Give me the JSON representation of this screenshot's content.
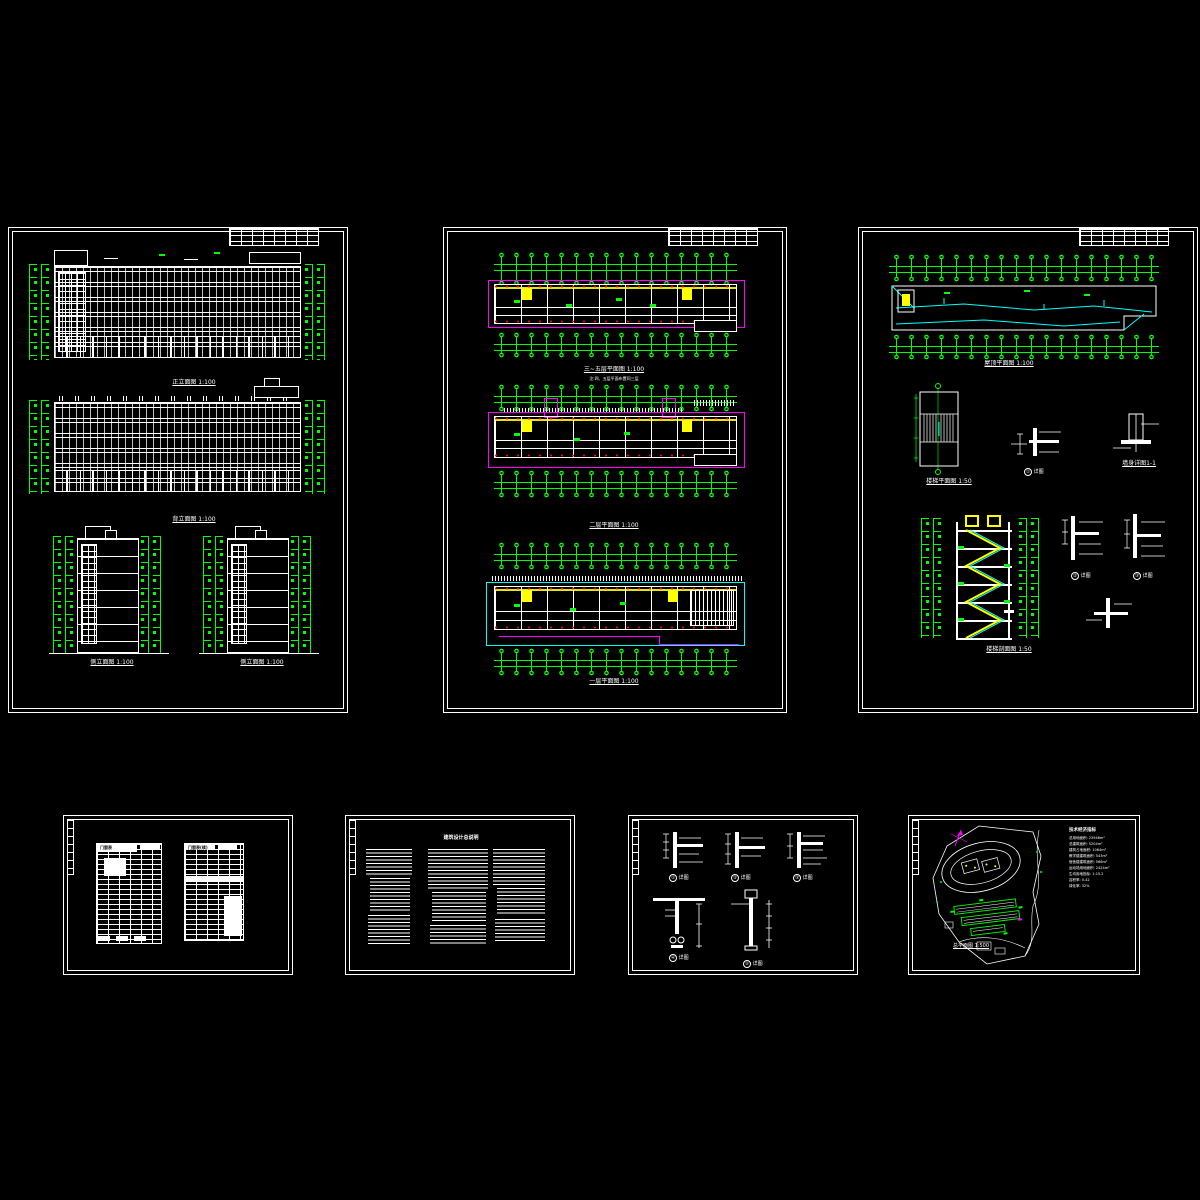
{
  "canvas": {
    "background": "#000000"
  },
  "palette": {
    "line": "#ffffff",
    "dimension": "#00ff00",
    "wall_axis": "#ff00ff",
    "auxiliary": "#00ffff",
    "highlight": "#ffff00",
    "node": "#ff0000"
  },
  "sheets": {
    "elevations": {
      "label": "立面图图纸",
      "titles": {
        "front": "正立面图 1:100",
        "rear": "背立面图 1:100",
        "side_left": "侧立面图 1:100",
        "side_right": "侧立面图 1:100"
      }
    },
    "plans": {
      "label": "平面图图纸",
      "titles": {
        "upper": "三~五层平面图 1:100",
        "upper_note": "注:四、五层平面布置同三层",
        "second": "二层平面图 1:100",
        "first": "一层平面图 1:100"
      }
    },
    "roof": {
      "label": "屋顶及楼梯详图图纸",
      "titles": {
        "roof_plan": "屋顶平面图 1:100",
        "stair_plan": "楼梯平面图 1:50",
        "stair_section": "楼梯剖面图 1:50",
        "wall_section": "墙身详图1-1"
      },
      "detail_items": [
        {
          "num": "①",
          "name": "详图"
        },
        {
          "num": "②",
          "name": "详图"
        },
        {
          "num": "③",
          "name": "详图"
        }
      ]
    },
    "schedule": {
      "label": "门窗表图纸",
      "table1_title": "门窗表",
      "table2_title": "门窗表(续)"
    },
    "notes": {
      "label": "设计说明图纸",
      "title": "建筑设计总说明"
    },
    "details": {
      "label": "节点详图图纸",
      "items": [
        {
          "num": "①",
          "name": "详图"
        },
        {
          "num": "②",
          "name": "详图"
        },
        {
          "num": "③",
          "name": "详图"
        },
        {
          "num": "④",
          "name": "详图"
        },
        {
          "num": "⑤",
          "name": "详图"
        }
      ]
    },
    "site": {
      "label": "总平面图图纸",
      "title": "总平面图 1:500",
      "indicators": {
        "title": "技术经济指标",
        "lines": [
          "总用地面积: 23946m²",
          "总建筑面积: 5204m²",
          "建筑占地面积: 1064m²",
          "教学楼建筑面积: 543m²",
          "宿舍楼建筑面积: 566m²",
          "运动场用地面积: 2424m²",
          "生均用地指标: 1:15.2",
          "容积率: 0.42",
          "绿化率: 32%"
        ]
      }
    }
  }
}
